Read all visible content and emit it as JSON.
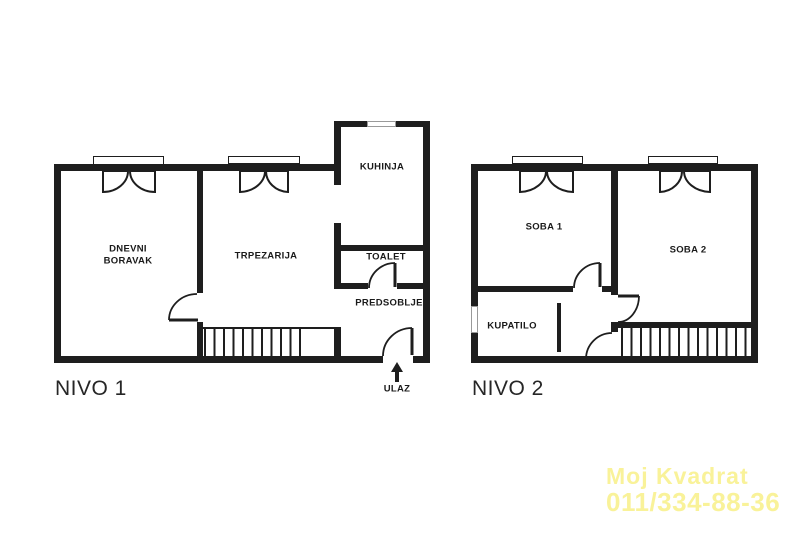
{
  "document": {
    "type": "apartment floor plan, two levels"
  },
  "plans": [
    {
      "id": "nivo1",
      "title": "NIVO 1",
      "rooms": [
        {
          "key": "living",
          "label": "DNEVNI BORAVAK"
        },
        {
          "key": "dining",
          "label": "TRPEZARIJA"
        },
        {
          "key": "kitchen",
          "label": "KUHINJA"
        },
        {
          "key": "toilet",
          "label": "TOALET"
        },
        {
          "key": "hallway",
          "label": "PREDSOBLJE"
        }
      ],
      "entrance_label": "ULAZ"
    },
    {
      "id": "nivo2",
      "title": "NIVO 2",
      "rooms": [
        {
          "key": "bedroom1",
          "label": "SOBA 1"
        },
        {
          "key": "bedroom2",
          "label": "SOBA 2"
        },
        {
          "key": "bathroom",
          "label": "KUPATILO"
        }
      ]
    }
  ],
  "watermark": {
    "line1": "Moj Kvadrat",
    "line2": "011/334-88-36",
    "color": "#f9f299"
  },
  "colors": {
    "wall": "#1e1e1e",
    "background": "#ffffff",
    "label_text": "#1a1a1a",
    "window_frame_gray": "#9a9a9a"
  }
}
